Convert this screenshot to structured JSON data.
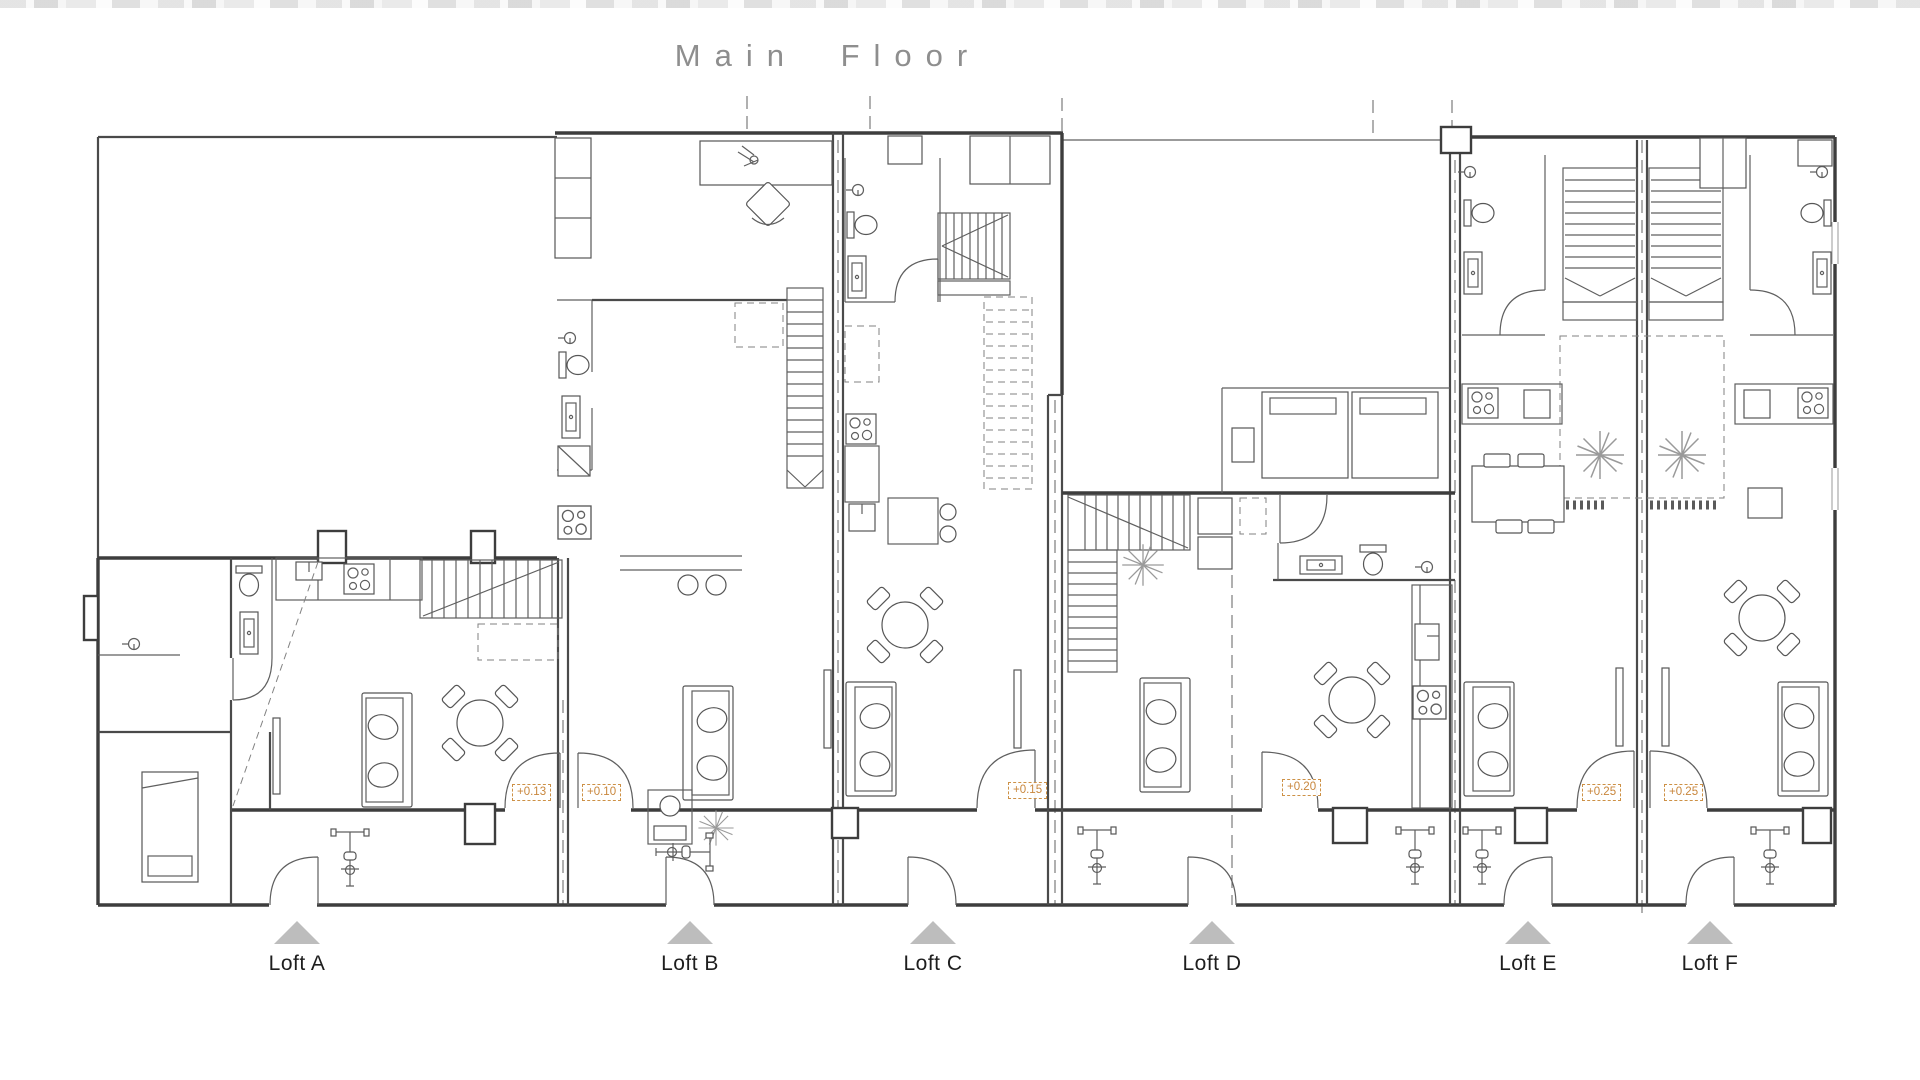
{
  "title": "Main Floor",
  "colors": {
    "wall": "#3d3d3d",
    "accent_orange": "#c8863c",
    "entrance_triangle": "#bdbdbd",
    "title_gray": "#8e8e8e"
  },
  "lofts": [
    {
      "id": "A",
      "label": "Loft A",
      "elevation": "+0.13"
    },
    {
      "id": "B",
      "label": "Loft B",
      "elevation": "+0.10"
    },
    {
      "id": "C",
      "label": "Loft C",
      "elevation": "+0.15"
    },
    {
      "id": "D",
      "label": "Loft D",
      "elevation": "+0.20"
    },
    {
      "id": "E",
      "label": "Loft E",
      "elevation": "+0.25"
    },
    {
      "id": "F",
      "label": "Loft F",
      "elevation": "+0.25"
    }
  ]
}
